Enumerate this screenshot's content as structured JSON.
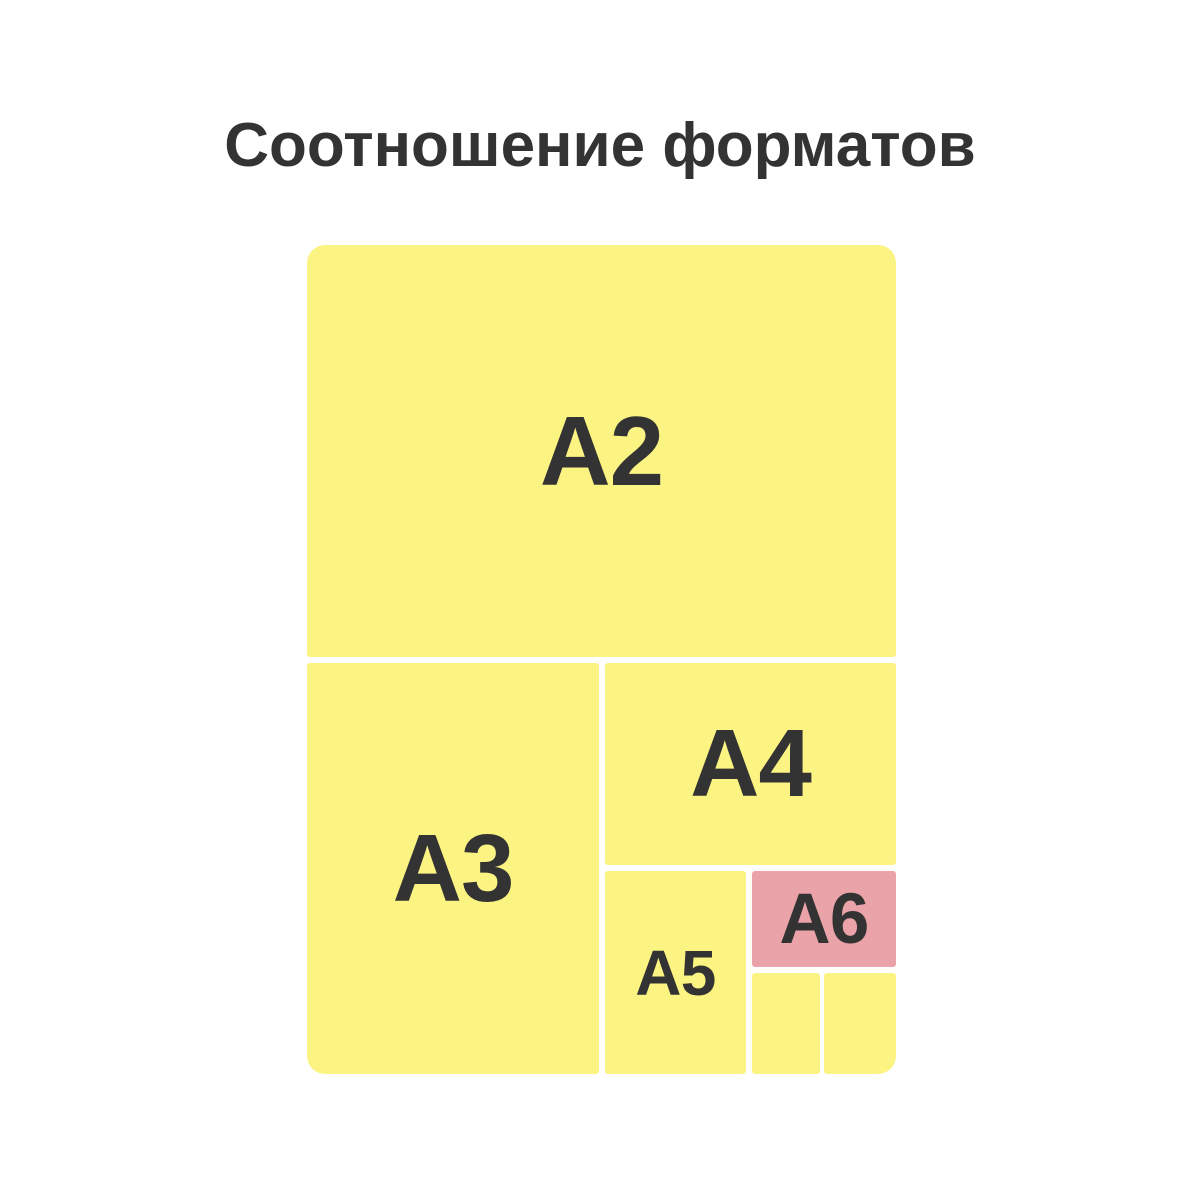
{
  "page": {
    "title": "Соотношение форматов"
  },
  "colors": {
    "background": "#ffffff",
    "sheet-yellow": "#fbf382",
    "sheet-pink": "#eba3aa",
    "label-text": "#333333"
  },
  "diagram": {
    "formats": [
      {
        "label": "A2",
        "fill": "yellow"
      },
      {
        "label": "A3",
        "fill": "yellow"
      },
      {
        "label": "A4",
        "fill": "yellow"
      },
      {
        "label": "A5",
        "fill": "yellow"
      },
      {
        "label": "A6",
        "fill": "pink"
      },
      {
        "label": "",
        "fill": "yellow"
      },
      {
        "label": "",
        "fill": "yellow"
      }
    ]
  }
}
